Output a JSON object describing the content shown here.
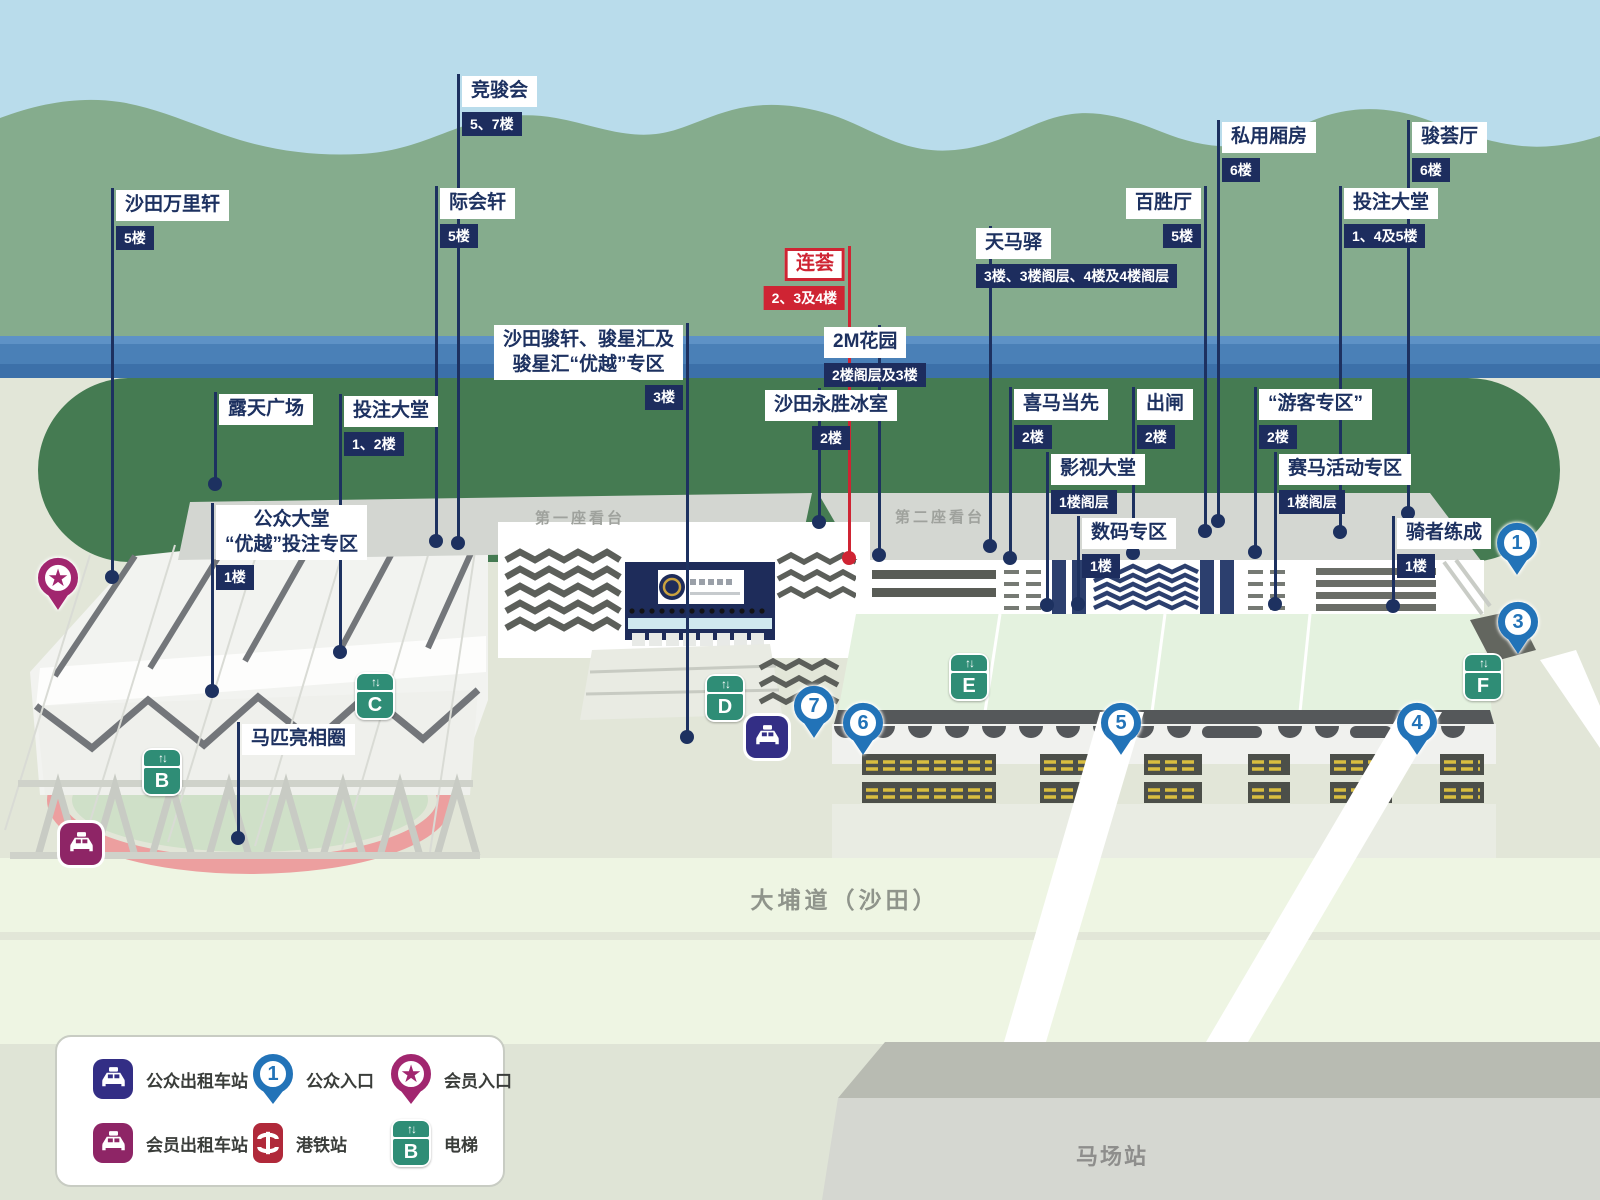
{
  "colors": {
    "label_navy": "#1d3160",
    "badge_navy": "#1d2d5e",
    "highlight_red": "#cf2433",
    "entrance_pin_blue": "#2273b8",
    "member_magenta": "#a1266f",
    "lift_green": "#2f8d76",
    "mtr_red": "#b0293a",
    "taxi_public_navy": "#332e85",
    "taxi_member_magenta": "#8e2566"
  },
  "icons": {
    "lift_arrows": "↑↓",
    "member_star": "★"
  },
  "grandstands": {
    "first": "第一座看台",
    "second": "第二座看台"
  },
  "road_label": "大埔道（沙田）",
  "station_label": "马场站",
  "callouts": [
    {
      "id": "jockey-club",
      "name": "竞骏会",
      "floor": "5、7楼",
      "x": 458,
      "top": 74,
      "dot": 543
    },
    {
      "id": "shatin-panorama",
      "name": "沙田万里轩",
      "floor": "5楼",
      "x": 112,
      "top": 188,
      "dot": 577
    },
    {
      "id": "gathering-pavilion",
      "name": "际会轩",
      "floor": "5楼",
      "x": 436,
      "top": 186,
      "dot": 541
    },
    {
      "id": "private-boxes",
      "name": "私用厢房",
      "floor": "6楼",
      "x": 1218,
      "top": 120,
      "dot": 521
    },
    {
      "id": "jun-hui-hall",
      "name": "骏荟厅",
      "floor": "6楼",
      "x": 1408,
      "top": 120,
      "dot": 513
    },
    {
      "id": "hundred-wins-hall",
      "name": "百胜厅",
      "floor": "5楼",
      "x": 1205,
      "top": 186,
      "dot": 531,
      "side": "left"
    },
    {
      "id": "betting-hall-upper",
      "name": "投注大堂",
      "floor": "1、4及5楼",
      "x": 1340,
      "top": 186,
      "dot": 532
    },
    {
      "id": "tin-ma-station",
      "name": "天马驿",
      "floor": "3楼、3楼阁层、4楼及4楼阁层",
      "x": 990,
      "top": 226,
      "dot": 546,
      "dx": -14
    },
    {
      "id": "lian-hui",
      "name": "连荟",
      "floor": "2、3及4楼",
      "x": 849,
      "top": 246,
      "dot": 558,
      "side": "left",
      "red": true
    },
    {
      "id": "2m-garden",
      "name": "2M花园",
      "floor": "2楼阁层及3楼",
      "x": 879,
      "top": 325,
      "dot": 555,
      "dx": -55
    },
    {
      "id": "shatin-gallery-premier",
      "name": "沙田骏轩、骏星汇及\n骏星汇“优越”专区",
      "floor": "3楼",
      "x": 687,
      "top": 323,
      "dot": 737,
      "side": "left"
    },
    {
      "id": "wing-sing-icehouse",
      "name": "沙田永胜冰室",
      "floor": "2楼",
      "x": 819,
      "top": 388,
      "dot": 522,
      "dx": -54,
      "badge_align": "center"
    },
    {
      "id": "open-plaza",
      "name": "露天广场",
      "x": 215,
      "top": 392,
      "dot": 484
    },
    {
      "id": "betting-hall-lower",
      "name": "投注大堂",
      "floor": "1、2楼",
      "x": 340,
      "top": 394,
      "dot": 652
    },
    {
      "id": "winning-ahead",
      "name": "喜马当先",
      "floor": "2楼",
      "x": 1010,
      "top": 387,
      "dot": 558
    },
    {
      "id": "starting-gate",
      "name": "出闸",
      "floor": "2楼",
      "x": 1133,
      "top": 387,
      "dot": 553
    },
    {
      "id": "tourist-zone",
      "name": "“游客专区”",
      "floor": "2楼",
      "x": 1255,
      "top": 387,
      "dot": 552
    },
    {
      "id": "tv-hall",
      "name": "影视大堂",
      "floor": "1楼阁层",
      "x": 1047,
      "top": 452,
      "dot": 605
    },
    {
      "id": "racing-activity-zone",
      "name": "赛马活动专区",
      "floor": "1楼阁层",
      "x": 1275,
      "top": 452,
      "dot": 604
    },
    {
      "id": "digital-zone",
      "name": "数码专区",
      "floor": "1楼",
      "x": 1078,
      "top": 516,
      "dot": 604
    },
    {
      "id": "riders-training",
      "name": "骑者练成",
      "floor": "1楼",
      "x": 1393,
      "top": 516,
      "dot": 606
    },
    {
      "id": "public-hall-premier",
      "name": "公众大堂\n“优越”投注专区",
      "floor": "1楼",
      "x": 212,
      "top": 503,
      "dot": 691
    },
    {
      "id": "parade-ring",
      "name": "马匹亮相圈",
      "x": 238,
      "top": 722,
      "dot": 838
    }
  ],
  "entrance_pins": [
    {
      "num": "1",
      "x": 1517,
      "y": 551
    },
    {
      "num": "3",
      "x": 1518,
      "y": 630
    },
    {
      "num": "4",
      "x": 1417,
      "y": 731
    },
    {
      "num": "5",
      "x": 1121,
      "y": 731
    },
    {
      "num": "6",
      "x": 863,
      "y": 731
    },
    {
      "num": "7",
      "x": 814,
      "y": 714
    }
  ],
  "lifts": [
    {
      "letter": "B",
      "x": 162,
      "y": 772
    },
    {
      "letter": "C",
      "x": 375,
      "y": 696
    },
    {
      "letter": "D",
      "x": 725,
      "y": 698
    },
    {
      "letter": "E",
      "x": 969,
      "y": 677
    },
    {
      "letter": "F",
      "x": 1483,
      "y": 677
    }
  ],
  "taxi_stands": [
    {
      "type": "public",
      "x": 767,
      "y": 737
    },
    {
      "type": "member",
      "x": 81,
      "y": 844
    }
  ],
  "member_pin": {
    "x": 58,
    "y": 586
  },
  "legend": {
    "items": [
      {
        "icon": "taxi-public",
        "label": "公众出租车站"
      },
      {
        "icon": "entrance-pin",
        "label": "公众入口",
        "pin_num": "1"
      },
      {
        "icon": "member-pin",
        "label": "会员入口"
      },
      {
        "icon": "taxi-member",
        "label": "会员出租车站"
      },
      {
        "icon": "mtr",
        "label": "港铁站"
      },
      {
        "icon": "lift",
        "label": "电梯",
        "lift_letter": "B"
      }
    ]
  }
}
